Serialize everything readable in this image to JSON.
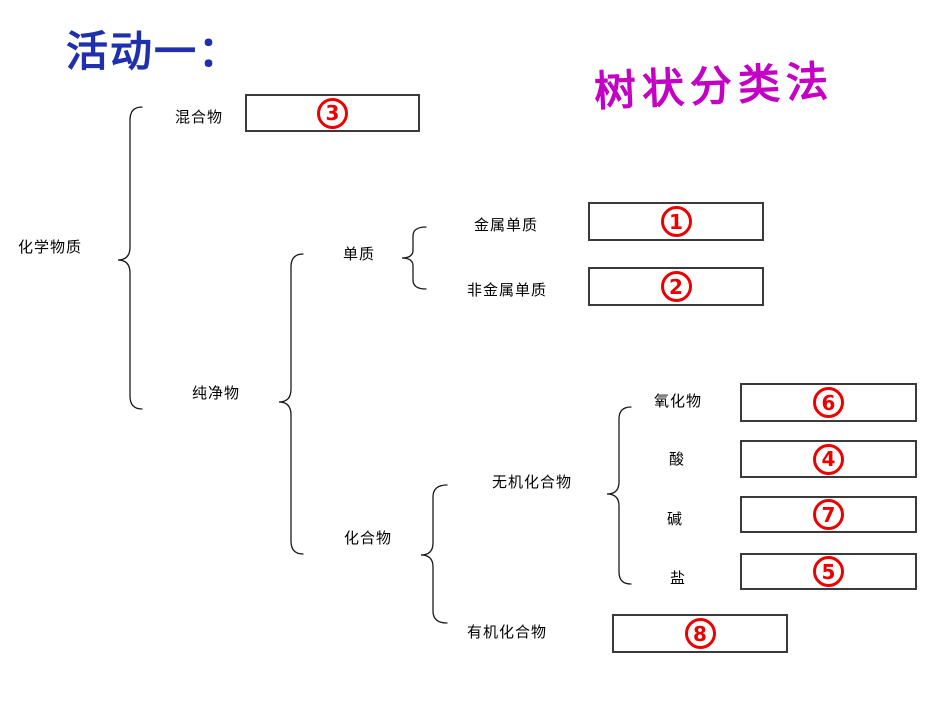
{
  "slide": {
    "title": "活动一：",
    "subtitle": "树状分类法"
  },
  "colors": {
    "title_blue": "#1f2fae",
    "subtitle_magenta": "#c400c4",
    "answer_red": "#ee0000",
    "box_border": "#3a3a3a"
  },
  "tree": {
    "root_label": "化学物质",
    "level1": {
      "mixture": "混合物",
      "pure": "纯净物"
    },
    "level2": {
      "element": "单质",
      "compound": "化合物"
    },
    "level3": {
      "metal_element": "金属单质",
      "nonmetal_element": "非金属单质",
      "inorganic": "无机化合物",
      "organic": "有机化合物"
    },
    "level4": {
      "oxide": "氧化物",
      "acid": "酸",
      "base": "碱",
      "salt": "盐"
    }
  },
  "answer_boxes": {
    "box1": "1",
    "box2": "2",
    "box3": "3",
    "box4": "4",
    "box5": "5",
    "box6": "6",
    "box7": "7",
    "box8": "8"
  }
}
